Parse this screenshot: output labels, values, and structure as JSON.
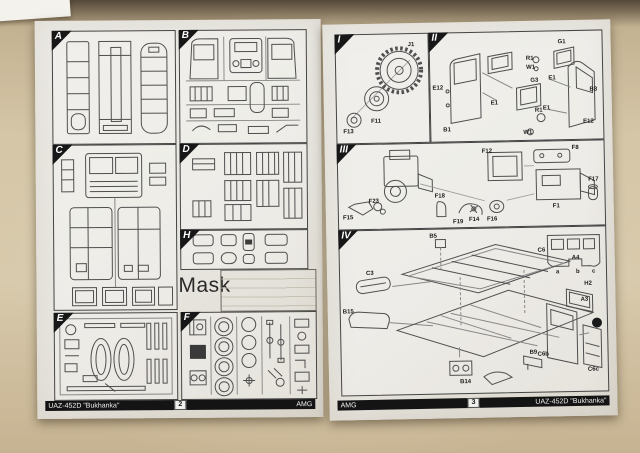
{
  "colors": {
    "table_surface": "#d5c6a7",
    "page": "#e8e6e0",
    "ink": "#4f4f4f",
    "badge": "#151515"
  },
  "left_page": {
    "page_number": "2",
    "footer_title": "UAZ-452D \"Bukhanka\"",
    "footer_brand": "AMG",
    "mask_label": "Mask",
    "sections": [
      {
        "label": "A"
      },
      {
        "label": "B"
      },
      {
        "label": "C"
      },
      {
        "label": "D"
      },
      {
        "label": "H"
      },
      {
        "label": "E"
      },
      {
        "label": "F"
      }
    ]
  },
  "right_page": {
    "page_number": "3",
    "footer_title": "UAZ-452D \"Bukhanka\"",
    "footer_brand": "AMG",
    "sections": [
      {
        "label": "I",
        "parts": [
          "J1",
          "F11",
          "F13"
        ]
      },
      {
        "label": "II",
        "parts": [
          "E12",
          "B1",
          "E1",
          "G3",
          "R1",
          "W1",
          "G1",
          "R1",
          "W1",
          "E1",
          "B3",
          "E1",
          "E12"
        ]
      },
      {
        "label": "III",
        "parts": [
          "F15",
          "F23",
          "F18",
          "F19",
          "F14",
          "F16",
          "F12",
          "F8",
          "F1",
          "F17"
        ]
      },
      {
        "label": "IV",
        "parts": [
          "B5",
          "C3",
          "B15",
          "A4",
          "A3",
          "B14",
          "B9",
          "C6",
          "a",
          "b",
          "c",
          "H2",
          "C6b",
          "C6c"
        ]
      }
    ]
  }
}
